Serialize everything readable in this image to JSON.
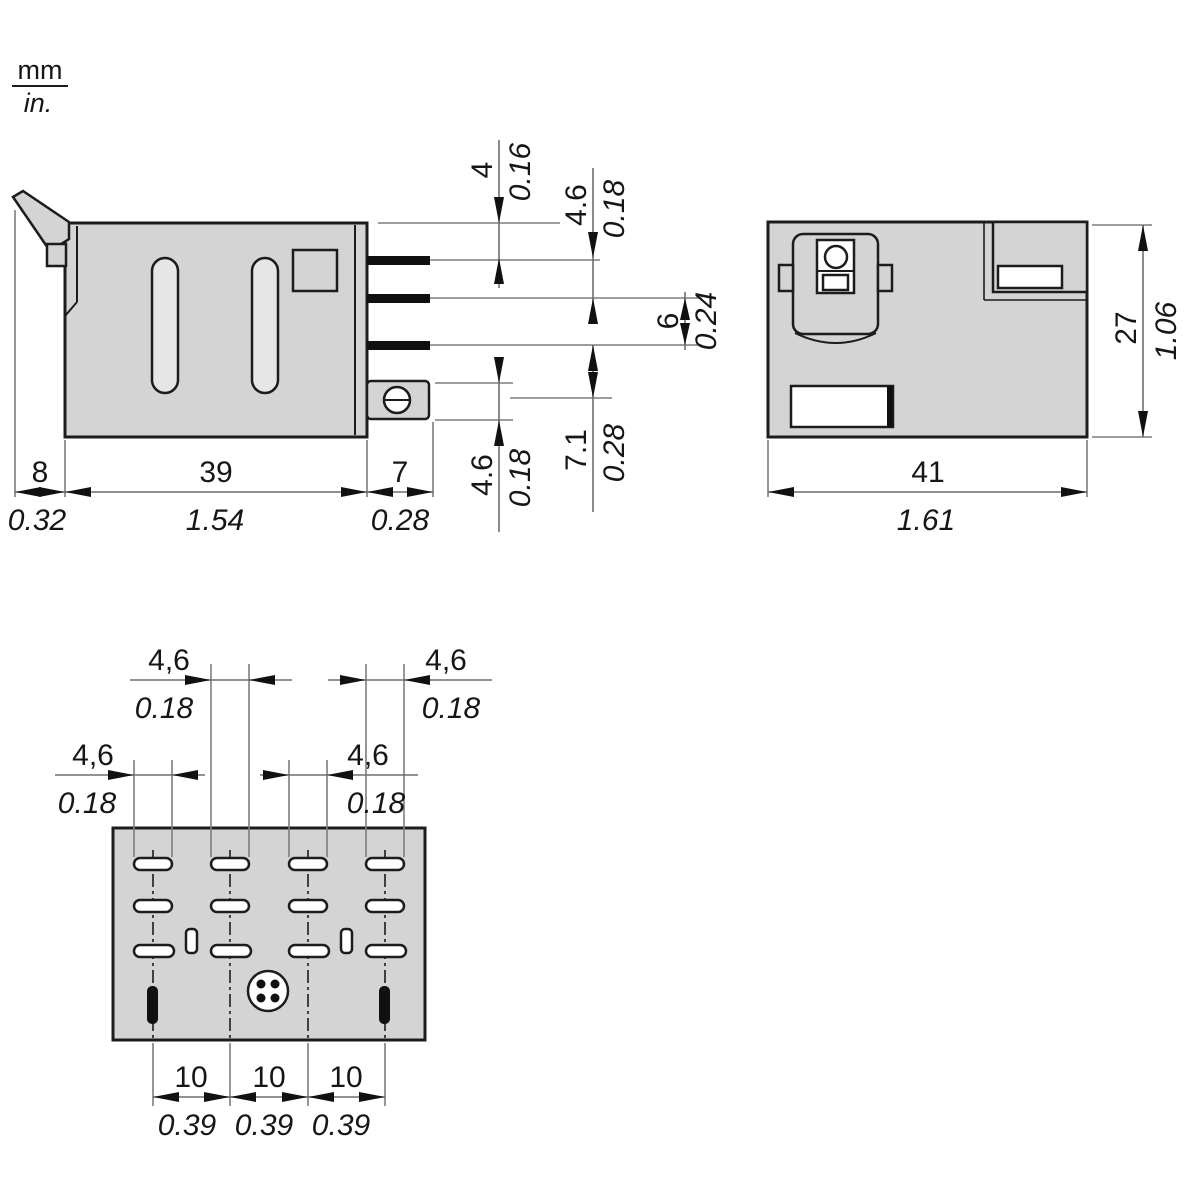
{
  "legend": {
    "unit_top": "mm",
    "unit_bottom": "in."
  },
  "side_view": {
    "width_left": {
      "mm": "8",
      "inch": "0.32"
    },
    "width_body": {
      "mm": "39",
      "inch": "1.54"
    },
    "width_pins": {
      "mm": "7",
      "inch": "0.28"
    },
    "top_to_pin1": {
      "mm": "4",
      "inch": "0.16"
    },
    "pin1_to_pin2": {
      "mm": "4.6",
      "inch": "0.18"
    },
    "pin2_to_pin3": {
      "mm": "6",
      "inch": "0.24"
    },
    "pin3_to_lug": {
      "mm": "7.1",
      "inch": "0.28"
    },
    "lug_height": {
      "mm": "4.6",
      "inch": "0.18"
    }
  },
  "top_view": {
    "width": {
      "mm": "41",
      "inch": "1.61"
    },
    "height": {
      "mm": "27",
      "inch": "1.06"
    }
  },
  "bottom_view": {
    "slot_width_col1": {
      "mm": "4,6",
      "inch": "0.18"
    },
    "slot_width_col2": {
      "mm": "4,6",
      "inch": "0.18"
    },
    "slot_width_col3": {
      "mm": "4,6",
      "inch": "0.18"
    },
    "slot_width_col4": {
      "mm": "4,6",
      "inch": "0.18"
    },
    "pin_pitch_1": {
      "mm": "10",
      "inch": "0.39"
    },
    "pin_pitch_2": {
      "mm": "10",
      "inch": "0.39"
    },
    "pin_pitch_3": {
      "mm": "10",
      "inch": "0.39"
    }
  },
  "colors": {
    "body_fill": "#d4d4d4",
    "outline": "#1c1c1c",
    "dim_line": "#7a7a7a",
    "text": "#161616"
  }
}
